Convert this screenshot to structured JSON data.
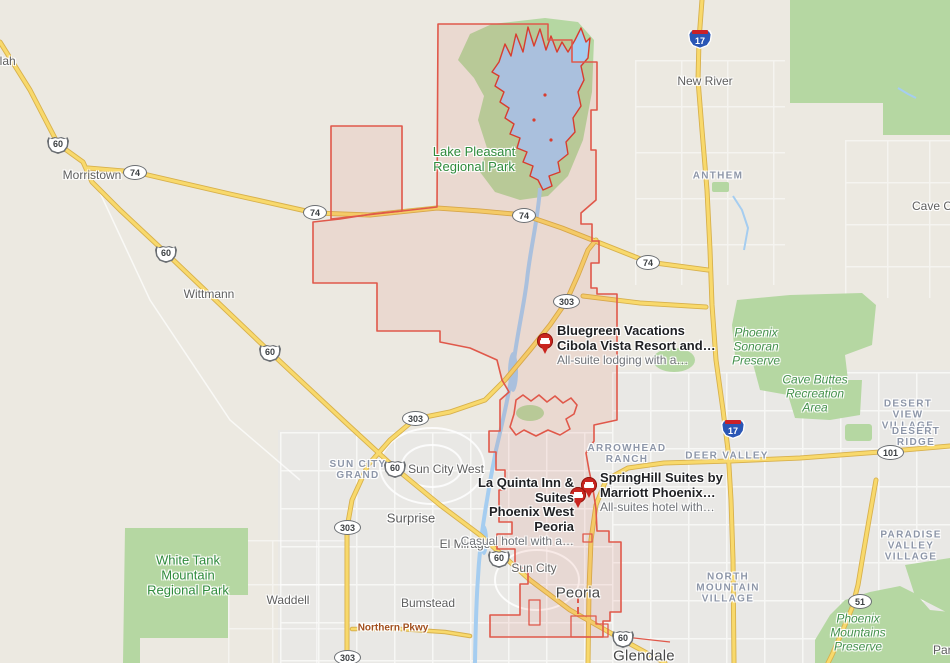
{
  "map_type": "road-map",
  "colors": {
    "land": "#ece9e1",
    "urban": "#e9e8e5",
    "water": "#a5cdf0",
    "park_green": "#b5d7a2",
    "road_yellow": "#f8d96c",
    "road_yellow_casing": "#d8b14c",
    "boundary_red": "#e0584a",
    "pin_red": "#c9251f",
    "park_label_green": "#2f8b3c",
    "preserve_label_green": "#44914c",
    "neighborhood_label": "#8d96a8",
    "town_label": "#5f5f5f",
    "road_label_brown": "#a24f1e"
  },
  "shields": {
    "i17": "17",
    "us60": "60",
    "sr74": "74",
    "sr303": "303",
    "loop101": "101",
    "sr51": "51"
  },
  "labels": {
    "towns": {
      "partial_left": "llah",
      "morristown": "Morristown",
      "wittmann": "Wittmann",
      "new_river": "New River",
      "cave_creek_partial": "Cave Cre",
      "surprise": "Surprise",
      "el_mirage": "El Mirage",
      "sun_city": "Sun City",
      "sun_city_west": "Sun City West",
      "waddell": "Waddell",
      "bumstead": "Bumstead",
      "peoria": "Peoria",
      "glendale": "Glendale",
      "paradise_partial": "Para"
    },
    "neighborhoods": {
      "anthem": "ANTHEM",
      "sun_city_grand": "SUN CITY\nGRAND",
      "arrowhead_ranch": "ARROWHEAD\nRANCH",
      "deer_valley": "DEER VALLEY",
      "desert_view_village": "DESERT VIEW\nVILLAGE",
      "desert_ridge": "DESERT RIDGE",
      "north_mountain_village": "NORTH\nMOUNTAIN\nVILLAGE",
      "paradise_valley_village": "PARADISE\nVALLEY VILLAGE"
    },
    "parks": {
      "lake_pleasant": "Lake Pleasant\nRegional Park",
      "white_tank": "White Tank\nMountain\nRegional Park"
    },
    "preserves": {
      "phoenix_sonoran": "Phoenix\nSonoran\nPreserve",
      "cave_buttes": "Cave Buttes\nRecreation\nArea",
      "phoenix_mountains": "Phoenix\nMountains\nPreserve"
    },
    "roads": {
      "northern_pkwy": "Northern Pkwy"
    }
  },
  "hotels": {
    "bluegreen": {
      "title": "Bluegreen Vacations\nCibola Vista Resort and…",
      "subtitle": "All-suite lodging with a…"
    },
    "la_quinta": {
      "title": "La Quinta Inn & Suites\nPhoenix West Peoria",
      "subtitle": "Casual hotel with a…"
    },
    "springhill": {
      "title": "SpringHill Suites by\nMarriott Phoenix…",
      "subtitle": "All-suites hotel with…"
    }
  }
}
